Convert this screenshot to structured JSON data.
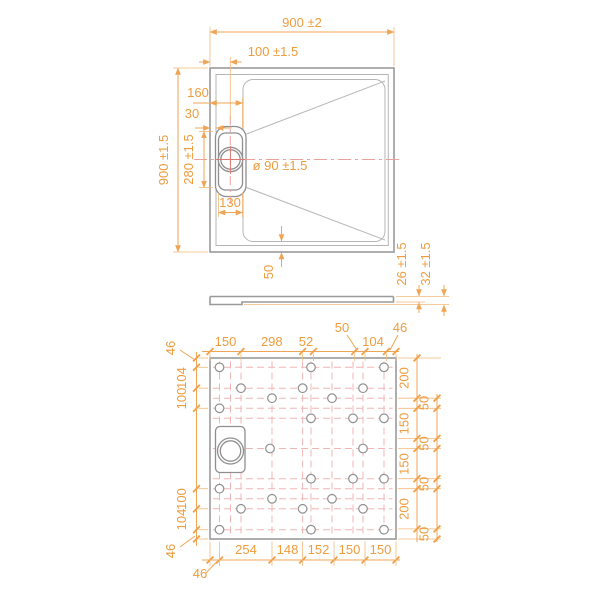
{
  "top_view": {
    "dim_width_total": "900 ±2",
    "dim_drain_center": "100 ±1.5",
    "dim_drain_edge": "160",
    "dim_rim_width": "30",
    "dim_height_total": "900 ±1.5",
    "dim_recess_height": "280 ±1.5",
    "dim_drain_width": "130",
    "dim_drain_diameter": "ø 90 ±1.5",
    "dim_bottom_inset": "50"
  },
  "side_view": {
    "dim_thickness": "26 ±1.5",
    "dim_total_height": "32 ±1.5"
  },
  "bottom_view": {
    "top_chain": [
      "150",
      "298",
      "52",
      "50",
      "104",
      "46"
    ],
    "left_chain": [
      "46",
      "104",
      "100",
      "100",
      "104",
      "46"
    ],
    "right_inner_chain": [
      "200",
      "150",
      "150",
      "200"
    ],
    "right_outer_chain": [
      "50",
      "50",
      "50",
      "50"
    ],
    "bottom_chain": [
      "46",
      "254",
      "148",
      "152",
      "150",
      "150"
    ],
    "feet": [
      [
        219.5,
        367.3
      ],
      [
        311,
        367.3
      ],
      [
        384,
        367.3
      ],
      [
        241,
        388.2
      ],
      [
        302.6,
        388.2
      ],
      [
        363,
        388.2
      ],
      [
        272,
        398.2
      ],
      [
        332,
        398.2
      ],
      [
        219.5,
        408.3
      ],
      [
        311,
        418.3
      ],
      [
        353,
        418.3
      ],
      [
        384,
        418.3
      ],
      [
        270,
        448.5
      ],
      [
        363,
        448.5
      ],
      [
        311,
        478.7
      ],
      [
        353,
        478.7
      ],
      [
        384,
        478.7
      ],
      [
        219.5,
        488.7
      ],
      [
        272,
        498.8
      ],
      [
        332,
        498.8
      ],
      [
        241,
        508.8
      ],
      [
        302.6,
        508.8
      ],
      [
        363,
        508.8
      ],
      [
        219.5,
        529.7
      ],
      [
        311,
        529.7
      ],
      [
        384,
        529.7
      ]
    ],
    "grid_rows": [
      367.3,
      388.2,
      398.2,
      408.3,
      418.3,
      448.5,
      478.7,
      488.7,
      498.8,
      508.8,
      529.7
    ],
    "grid_cols": [
      219.5,
      230.5,
      241,
      272,
      302.6,
      311,
      332,
      353,
      363,
      384
    ]
  },
  "colors": {
    "dimension_text": "#ee9c3e",
    "dimension_line": "#f0a455",
    "outline_gray": "#9a9a9a",
    "centerline_pink": "#f0b6b6",
    "feet_outline": "#8f8f8f"
  }
}
